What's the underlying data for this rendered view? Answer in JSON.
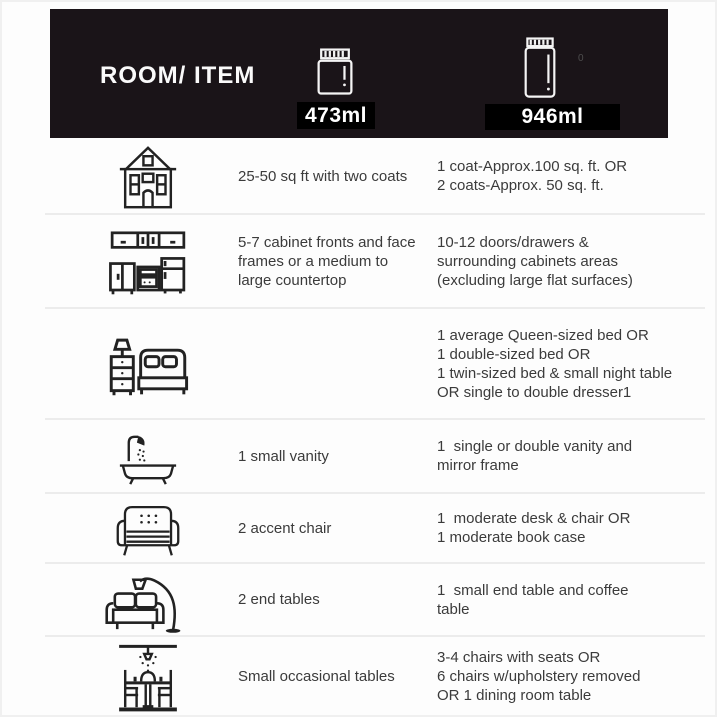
{
  "header": {
    "title": "ROOM/ ITEM",
    "small_can": {
      "label": "473ml",
      "icon": "paint-can-small-icon"
    },
    "large_can": {
      "label": "946ml",
      "icon": "paint-can-large-icon"
    },
    "watermark": "0",
    "colors": {
      "header_bg": "#1a1418",
      "badge_bg": "#000000",
      "badge_text": "#ffffff"
    }
  },
  "rows": [
    {
      "icon": "house-icon",
      "item": [
        "25-50 sq ft with two coats"
      ],
      "large": [
        "1 coat-Approx.100 sq. ft. OR",
        "2 coats-Approx. 50 sq. ft."
      ]
    },
    {
      "icon": "kitchen-cabinets-icon",
      "item": [
        "5-7 cabinet fronts and face",
        "frames or a medium to",
        "large countertop"
      ],
      "large": [
        "10-12 doors/drawers &",
        "surrounding cabinets areas",
        "(excluding large flat surfaces)"
      ]
    },
    {
      "icon": "bedroom-icon",
      "item": [],
      "large": [
        "1 average Queen-sized bed OR",
        "1 double-sized bed OR",
        "1 twin-sized bed & small night table",
        "OR single to double dresser1"
      ]
    },
    {
      "icon": "bathtub-shower-icon",
      "item": [
        "1 small vanity"
      ],
      "large": [
        "1  single or double vanity and",
        "mirror frame"
      ]
    },
    {
      "icon": "accent-chair-icon",
      "item": [
        "2 accent chair"
      ],
      "large": [
        "1  moderate desk & chair OR",
        "1 moderate book case"
      ]
    },
    {
      "icon": "sofa-floor-lamp-icon",
      "item": [
        "2 end tables"
      ],
      "large": [
        "1  small end table and coffee",
        "table"
      ]
    },
    {
      "icon": "dining-table-icon",
      "item": [
        "Small occasional tables"
      ],
      "large": [
        "3-4 chairs with seats OR",
        "6 chairs w/upholstery removed",
        "OR 1 dining room table"
      ]
    }
  ],
  "colors": {
    "text": "#3b3b3b",
    "separator": "#ececec"
  }
}
